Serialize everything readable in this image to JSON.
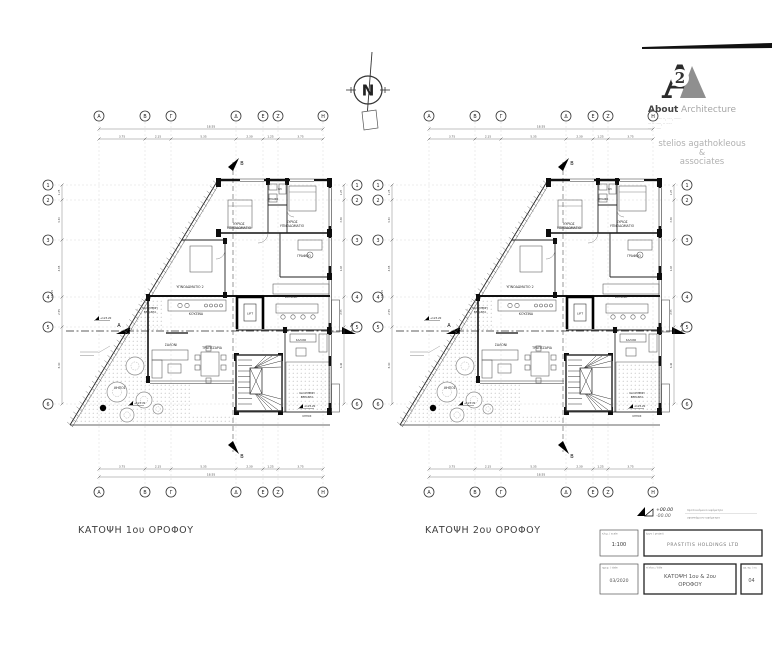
{
  "sheet": {
    "background": "#ffffff",
    "ink": "#1a1a1a",
    "gray": "#999999"
  },
  "north": {
    "letter": "N"
  },
  "logo": {
    "mark_letter": "A",
    "mark_number": "2",
    "brand_bold": "About",
    "brand_light": "Architecture",
    "address_lines": [
      "··· ········· ··, ····, ·······",
      "··· ·· ·····, ·· ·····",
      "··· ·· ·····"
    ],
    "firm_lines": [
      "stelios agathokleous",
      "&",
      "associates"
    ]
  },
  "plan_template": {
    "grid_cols": [
      "Α",
      "Β",
      "Γ",
      "Δ",
      "Ε",
      "Ζ",
      "Η"
    ],
    "grid_rows": [
      "1",
      "2",
      "3",
      "4",
      "5",
      "6"
    ],
    "dim_overall": "18.55",
    "dim_segments": [
      "3.75",
      "2.15",
      "5.35",
      "2.30",
      "1.25",
      "3.75"
    ],
    "vdim_overall": "18.15",
    "vdim_segments": [
      "1.25",
      "3.30",
      "4.65",
      "2.55",
      "6.40"
    ],
    "section_a": "A",
    "section_b": "B",
    "lift_label": "LIFT",
    "labels": [
      {
        "t": "ΚΥΡΙΩΣ",
        "x": 199,
        "y": 125
      },
      {
        "t": "ΥΠΝΟΔΩΜΑΤΙΟ",
        "x": 199,
        "y": 129
      },
      {
        "t": "ΚΥΡΙΩΣ",
        "x": 252,
        "y": 123
      },
      {
        "t": "ΥΠΝΟΔΩΜΑΤΙΟ",
        "x": 252,
        "y": 127
      },
      {
        "t": "ΓΡΑΦΕΙΟ",
        "x": 264,
        "y": 157
      },
      {
        "t": "ΥΠΝΟΔΩΜΑΤΙΟ 2",
        "x": 150,
        "y": 188
      },
      {
        "t": "ΜΠΑΝΙΟ",
        "x": 233,
        "y": 100,
        "fs": 2.5
      },
      {
        "t": "WC",
        "x": 240,
        "y": 90,
        "fs": 2.5
      },
      {
        "t": "ΚΟΥΖΙΝΑ",
        "x": 156,
        "y": 215
      },
      {
        "t": "ΚΟΥΖΙΝΑ",
        "x": 251,
        "y": 198,
        "fs": 2.8
      },
      {
        "t": "ΚΑΛΥΜΕΝΗ",
        "x": 110,
        "y": 209,
        "fs": 2.7
      },
      {
        "t": "ΒΕΡΑΝΤΑ",
        "x": 110,
        "y": 213,
        "fs": 2.7
      },
      {
        "t": "ΣΑΛΟΝΙ",
        "x": 131,
        "y": 246
      },
      {
        "t": "ΤΡΑΠΕΖΑΡΙΑ",
        "x": 172,
        "y": 249
      },
      {
        "t": "ΣΑΛΟΝΙ",
        "x": 261,
        "y": 241,
        "fs": 2.7
      },
      {
        "t": "ΚΑΛΥΜΕΝΗ",
        "x": 267,
        "y": 294,
        "fs": 2.7
      },
      {
        "t": "ΒΕΡΑΝΤΑ",
        "x": 267,
        "y": 298,
        "fs": 2.7
      },
      {
        "t": "ΚΗΠΟΣ",
        "x": 267,
        "y": 317,
        "fs": 2.5
      },
      {
        "t": "ΚΗΠΟΣ",
        "x": 80,
        "y": 289
      }
    ],
    "levels": [
      {
        "t": "+123.70",
        "x": 92,
        "y": 304
      },
      {
        "t": "+123.20",
        "x": 58,
        "y": 219
      },
      {
        "t": "+123.20",
        "x": 262,
        "y": 307
      }
    ]
  },
  "plans": [
    {
      "caption": "ΚΑΤΟΨΗ 1ου ΟΡΟΦΟΥ"
    },
    {
      "caption": "ΚΑΤΟΨΗ 2ου ΟΡΟΦΟΥ"
    }
  ],
  "titleblock": {
    "legend_plus": "+00.00",
    "legend_minus": "-00.00",
    "legend_line1": "προτεινόμενο υψόμετρο",
    "legend_line2": "υφιστάμενο υψόμετρο",
    "scale_label": "κλιμ. / scale",
    "scale_value": "1:100",
    "project_label": "έργο / project",
    "project_value": "PRASTITIS HOLDINGS LTD",
    "date_label": "ημερ. / date",
    "date_value": "03/2020",
    "title_label": "τίτλος / title",
    "title_value_line1": "ΚΑΤΟΨΗ 1ου & 2ου",
    "title_value_line2": "ΟΡΟΦΟΥ",
    "number_label": "αρ. σχ. / no.",
    "number_value": "04"
  }
}
